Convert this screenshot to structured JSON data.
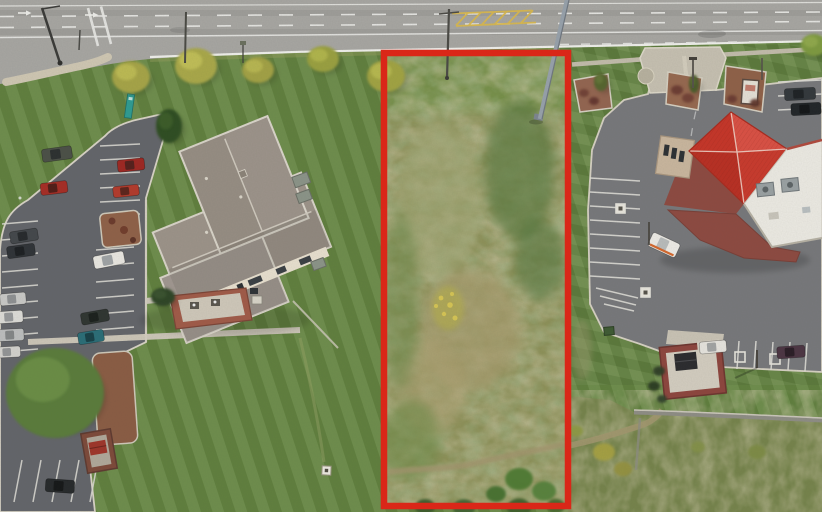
{
  "meta": {
    "description": "Aerial drone photo of a rectangular vacant land parcel outlined in red, between an office building with parking lot on the left and a red-roofed restaurant with drive-thru on the right, fronting a multi-lane road along the top"
  },
  "palette": {
    "lawn": "#668742",
    "parcel": "#8d9159",
    "road": "#a7a6a2",
    "asphalt_left": "#63656a",
    "asphalt_right": "#77787b",
    "outline_red": "#e02516",
    "office_roof": "#9c9389",
    "office_wall": "#e8e0cf",
    "restaurant_roof": "#d13b2d",
    "restaurant_wall": "#8d4a41",
    "flat_roof": "#eceae3",
    "concrete": "#c9c3b5",
    "autumn_tree": "#a6a446",
    "evergreen": "#2f4e20",
    "yellow_hatch": "#d9b84e"
  },
  "parcel_outline": {
    "x": 384,
    "y": 53,
    "width": 184,
    "height": 453,
    "color": "#e02516",
    "stroke_width": 6.5
  },
  "labels": {
    "photo": "aerial-lot-photo",
    "road": "multi-lane-road",
    "parcel": "vacant-parcel",
    "office": "office-building",
    "left_lot": "office-parking-lot",
    "restaurant": "restaurant-building",
    "right_lot": "restaurant-parking-lot",
    "wall": "retaining-wall",
    "path": "dirt-path"
  },
  "objects": {
    "cars": [
      {
        "x": 57,
        "y": 154,
        "l": 30,
        "w": 13,
        "a": -8,
        "c": "#4b5047",
        "g": "#2c3030"
      },
      {
        "x": 131,
        "y": 165,
        "l": 27,
        "w": 12,
        "a": -6,
        "c": "#9e2722",
        "g": "#55201c"
      },
      {
        "x": 54,
        "y": 188,
        "l": 27,
        "w": 12,
        "a": -7,
        "c": "#a62d25",
        "g": "#511d18"
      },
      {
        "x": 126,
        "y": 191,
        "l": 26,
        "w": 11,
        "a": -6,
        "c": "#b23a2c",
        "g": "#5c241c"
      },
      {
        "x": 24,
        "y": 236,
        "l": 28,
        "w": 12,
        "a": -9,
        "c": "#43474b",
        "g": "#26292c"
      },
      {
        "x": 21,
        "y": 251,
        "l": 28,
        "w": 12,
        "a": -8,
        "c": "#2f3337",
        "g": "#1c1f22"
      },
      {
        "x": 109,
        "y": 260,
        "l": 31,
        "w": 13,
        "a": -11,
        "c": "#e9e7e1",
        "g": "#9fa3a5"
      },
      {
        "x": 13,
        "y": 299,
        "l": 26,
        "w": 12,
        "a": -5,
        "c": "#c9c9c7",
        "g": "#8e9092"
      },
      {
        "x": 10,
        "y": 317,
        "l": 26,
        "w": 12,
        "a": -4,
        "c": "#dddcd8",
        "g": "#97999b"
      },
      {
        "x": 11,
        "y": 335,
        "l": 26,
        "w": 12,
        "a": -3,
        "c": "#bcbebe",
        "g": "#838687"
      },
      {
        "x": 8,
        "y": 352,
        "l": 25,
        "w": 11,
        "a": -3,
        "c": "#d3d2ce",
        "g": "#939596"
      },
      {
        "x": 95,
        "y": 317,
        "l": 28,
        "w": 12,
        "a": -10,
        "c": "#2f3531",
        "g": "#1b201d"
      },
      {
        "x": 91,
        "y": 337,
        "l": 26,
        "w": 12,
        "a": -9,
        "c": "#2a6d77",
        "g": "#174047"
      },
      {
        "x": 60,
        "y": 486,
        "l": 29,
        "w": 13,
        "a": 4,
        "c": "#26292b",
        "g": "#151718"
      },
      {
        "x": 800,
        "y": 94,
        "l": 31,
        "w": 12,
        "a": -3,
        "c": "#33383c",
        "g": "#1e2225"
      },
      {
        "x": 806,
        "y": 109,
        "l": 30,
        "w": 12,
        "a": -3,
        "c": "#212528",
        "g": "#131517"
      },
      {
        "x": 713,
        "y": 347,
        "l": 27,
        "w": 12,
        "a": -5,
        "c": "#e6e4de",
        "g": "#a2a4a4"
      },
      {
        "x": 791,
        "y": 352,
        "l": 28,
        "w": 12,
        "a": -4,
        "c": "#4c3543",
        "g": "#2a1d26"
      },
      {
        "x": 664,
        "y": 245,
        "l": 30,
        "w": 15,
        "a": 25,
        "c": "#edebe6",
        "g": "#b9bcbc",
        "stripe": "#d4682e"
      }
    ],
    "trees": [
      {
        "x": 131,
        "y": 77,
        "rx": 19,
        "ry": 16,
        "c": "#a6a446",
        "h": "#c4c258"
      },
      {
        "x": 196,
        "y": 66,
        "rx": 21,
        "ry": 18,
        "c": "#a9a84a",
        "h": "#c8c65c"
      },
      {
        "x": 258,
        "y": 70,
        "rx": 16,
        "ry": 13,
        "c": "#a2a145",
        "h": "#bfbe55"
      },
      {
        "x": 323,
        "y": 59,
        "rx": 16,
        "ry": 13,
        "c": "#9aa041",
        "h": "#b8bc50"
      },
      {
        "x": 386,
        "y": 76,
        "rx": 19,
        "ry": 16,
        "c": "#a1a343",
        "h": "#bec053"
      },
      {
        "x": 814,
        "y": 45,
        "rx": 13,
        "ry": 11,
        "c": "#7e9a40",
        "h": "#95ad50"
      },
      {
        "x": 169,
        "y": 126,
        "rx": 13,
        "ry": 17,
        "c": "#2f4e20",
        "h": "#3f612c"
      },
      {
        "x": 163,
        "y": 297,
        "rx": 12,
        "ry": 9,
        "c": "#2e4425",
        "h": "#3c5630"
      },
      {
        "x": 55,
        "y": 393,
        "rx": 49,
        "ry": 45,
        "c": "#5a7c3a",
        "h": "#6f9349"
      },
      {
        "x": 601,
        "y": 82,
        "rx": 7,
        "ry": 9,
        "c": "#55652f",
        "h": "#68793a"
      },
      {
        "x": 694,
        "y": 84,
        "rx": 5,
        "ry": 9,
        "c": "#4c5c2c",
        "h": "#5d7036"
      }
    ],
    "shrubs": [
      {
        "x": 584,
        "y": 93,
        "r": 5,
        "c": "#6f4034"
      },
      {
        "x": 594,
        "y": 101,
        "r": 5,
        "c": "#64362e"
      },
      {
        "x": 677,
        "y": 90,
        "r": 6,
        "c": "#6b3a33"
      },
      {
        "x": 688,
        "y": 98,
        "r": 6,
        "c": "#713f35"
      },
      {
        "x": 732,
        "y": 99,
        "r": 5,
        "c": "#6b3a33"
      },
      {
        "x": 755,
        "y": 103,
        "r": 5,
        "c": "#5f342c"
      },
      {
        "x": 659,
        "y": 371,
        "r": 6,
        "c": "#2e3d26"
      },
      {
        "x": 654,
        "y": 386,
        "r": 6,
        "c": "#2a3a23"
      },
      {
        "x": 662,
        "y": 399,
        "r": 5,
        "c": "#31422a"
      },
      {
        "x": 604,
        "y": 452,
        "r": 11,
        "c": "#a6a142"
      },
      {
        "x": 623,
        "y": 469,
        "r": 9,
        "c": "#949240"
      },
      {
        "x": 576,
        "y": 431,
        "r": 7,
        "c": "#8e9a45"
      },
      {
        "x": 519,
        "y": 479,
        "r": 14,
        "c": "#4d7a33"
      },
      {
        "x": 544,
        "y": 491,
        "r": 12,
        "c": "#55813a"
      },
      {
        "x": 496,
        "y": 494,
        "r": 10,
        "c": "#446f2e"
      },
      {
        "x": 425,
        "y": 507,
        "r": 10,
        "c": "#3a5a2c"
      },
      {
        "x": 464,
        "y": 508,
        "r": 11,
        "c": "#416330"
      },
      {
        "x": 519,
        "y": 508,
        "r": 12,
        "c": "#3c5e2c"
      },
      {
        "x": 556,
        "y": 506,
        "r": 9,
        "c": "#47692f"
      },
      {
        "x": 757,
        "y": 452,
        "r": 9,
        "c": "#7d8b44"
      },
      {
        "x": 698,
        "y": 447,
        "r": 7,
        "c": "#84914a"
      }
    ]
  }
}
